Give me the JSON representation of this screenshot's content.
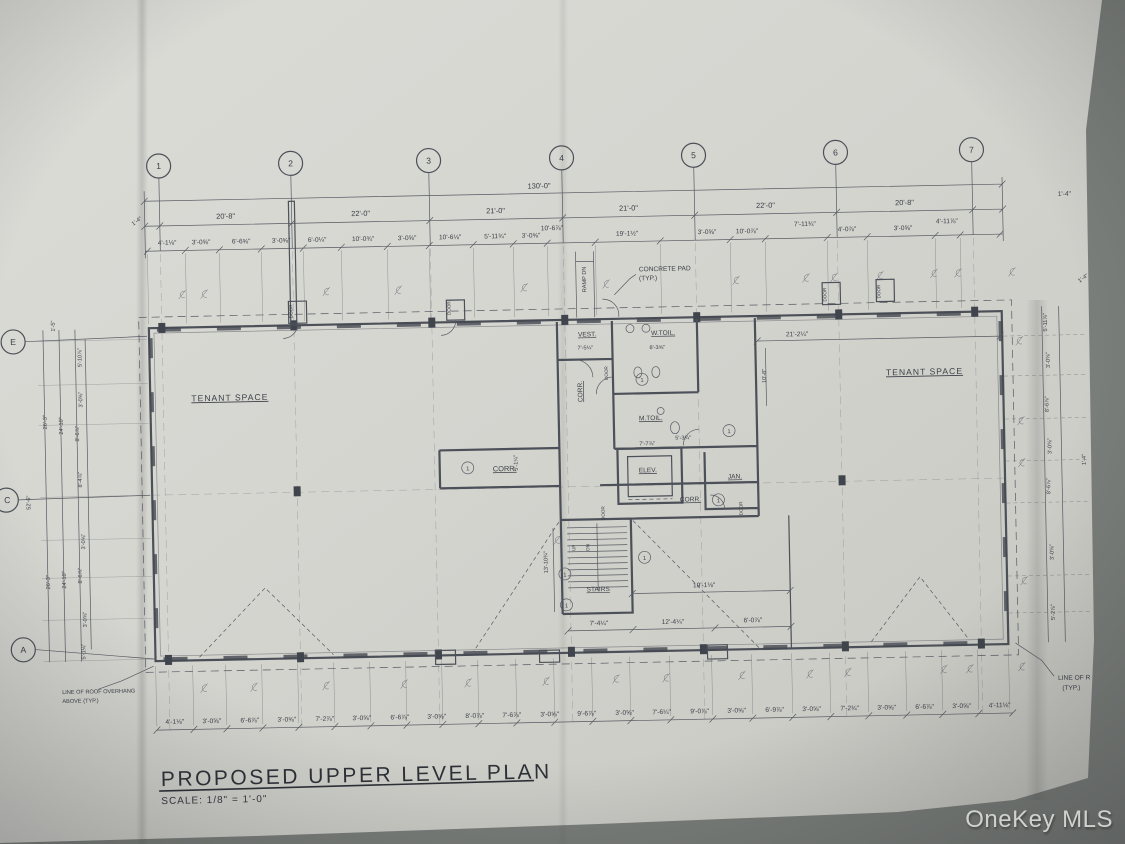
{
  "photo": {
    "watermark": "OneKey MLS"
  },
  "title_block": {
    "title": "PROPOSED UPPER LEVEL PLAN",
    "scale_note": "SCALE: 1/8\" = 1'-0\""
  },
  "grid": {
    "columns": [
      "1",
      "2",
      "3",
      "4",
      "5",
      "6",
      "7"
    ],
    "rows": [
      "E",
      "C",
      "A"
    ]
  },
  "dimensions": {
    "overall_width": "130'-0\"",
    "end_left": "1'-4\"",
    "end_right": "1'-4\"",
    "bays_top": [
      "20'-8\"",
      "22'-0\"",
      "21'-0\"",
      "21'-0\"",
      "22'-0\"",
      "20'-8\""
    ],
    "top_detail": [
      "4'-1⅛\"",
      "3'-0⅝\"",
      "6'-6⅝\"",
      "3'-0⅝\"",
      "6'-0¼\"",
      "10'-0¾\"",
      "3'-0⅝\"",
      "10'-6⅛\"",
      "5'-11¾\"",
      "3'-0⅝\"",
      "10'-6⅞\"",
      "19'-1½\"",
      "3'-0⅝\"",
      "10'-0⅞\"",
      "7'-11¾\"",
      "4'-0⅞\"",
      "3'-0⅝\"",
      "4'-11⅞\""
    ],
    "bottom_detail": [
      "4'-1⅛\"",
      "3'-0⅝\"",
      "6'-6⅞\"",
      "3'-0⅝\"",
      "7'-2⅞\"",
      "3'-0⅝\"",
      "6'-6⅞\"",
      "3'-0⅝\"",
      "8'-0⅞\"",
      "7'-6⅞\"",
      "3'-0⅝\"",
      "9'-6⅞\"",
      "3'-0⅝\"",
      "7'-6¼\"",
      "9'-0⅞\"",
      "3'-0⅝\"",
      "6'-9⅞\"",
      "3'-0⅝\"",
      "7'-2¾\"",
      "3'-0⅝\"",
      "6'-6⅞\"",
      "3'-0⅝\"",
      "4'-11⅛\""
    ],
    "left_side": [
      "1'-5\"",
      "5'-10⅞\"",
      "3'-0⅝\"",
      "8'-6⅞\"",
      "24'-10\"",
      "26'-3\"",
      "52'-6\"",
      "8'-4⅞\"",
      "3'-0⅝\"",
      "8'-6⅞\"",
      "24'-10\"",
      "26'-3\"",
      "3'-0⅝\"",
      "5'-1⅛\""
    ],
    "right_side": [
      "1'-4\"",
      "5'-11⅞\"",
      "3'-0⅝\"",
      "8'-6⅞\"",
      "3'-0⅝\"",
      "8'-6⅞\"",
      "3'-0⅝\"",
      "5'-2⅞\"",
      "1'-4\""
    ],
    "interior": {
      "vest_width": "7'-5¼\"",
      "wtoil_width": "8'-3⅝\"",
      "mtoil_width": "5'-3¼\"",
      "elev_width": "7'-7⅞\"",
      "right_clear": "21'-2¼\"",
      "right_depth": "10'-8\"",
      "stair_bay": "19'-1⅛\"",
      "stair_width": "7'-4¼\"",
      "lower_mid": "12'-4¼\"",
      "lower_right": "6'-0⅞\"",
      "stair_height": "13'-10¾\"",
      "corr_width": "5'-1¼\""
    }
  },
  "rooms": {
    "tenant_left": "TENANT SPACE",
    "tenant_right": "TENANT SPACE",
    "vest": "VEST.",
    "w_toil": "W.TOIL.",
    "m_toil": "M.TOIL.",
    "corr": "CORR.",
    "elev": "ELEV.",
    "jan": "JAN.",
    "stairs": "STAIRS"
  },
  "annotations": {
    "ramp_dn": "RAMP DN",
    "concrete_pad_line1": "CONCRETE PAD",
    "concrete_pad_line2": "(TYP.)",
    "roof_overhang_line1": "LINE OF ROOF OVERHANG",
    "roof_overhang_line2": "ABOVE (TYP.)",
    "line_of_r_line1": "LINE OF R",
    "line_of_r_line2": "(TYP.)",
    "door": "DOOR",
    "up": "UP",
    "dn": "DN"
  },
  "symbols": {
    "keynote": "1",
    "centerline_mark": "℄"
  }
}
